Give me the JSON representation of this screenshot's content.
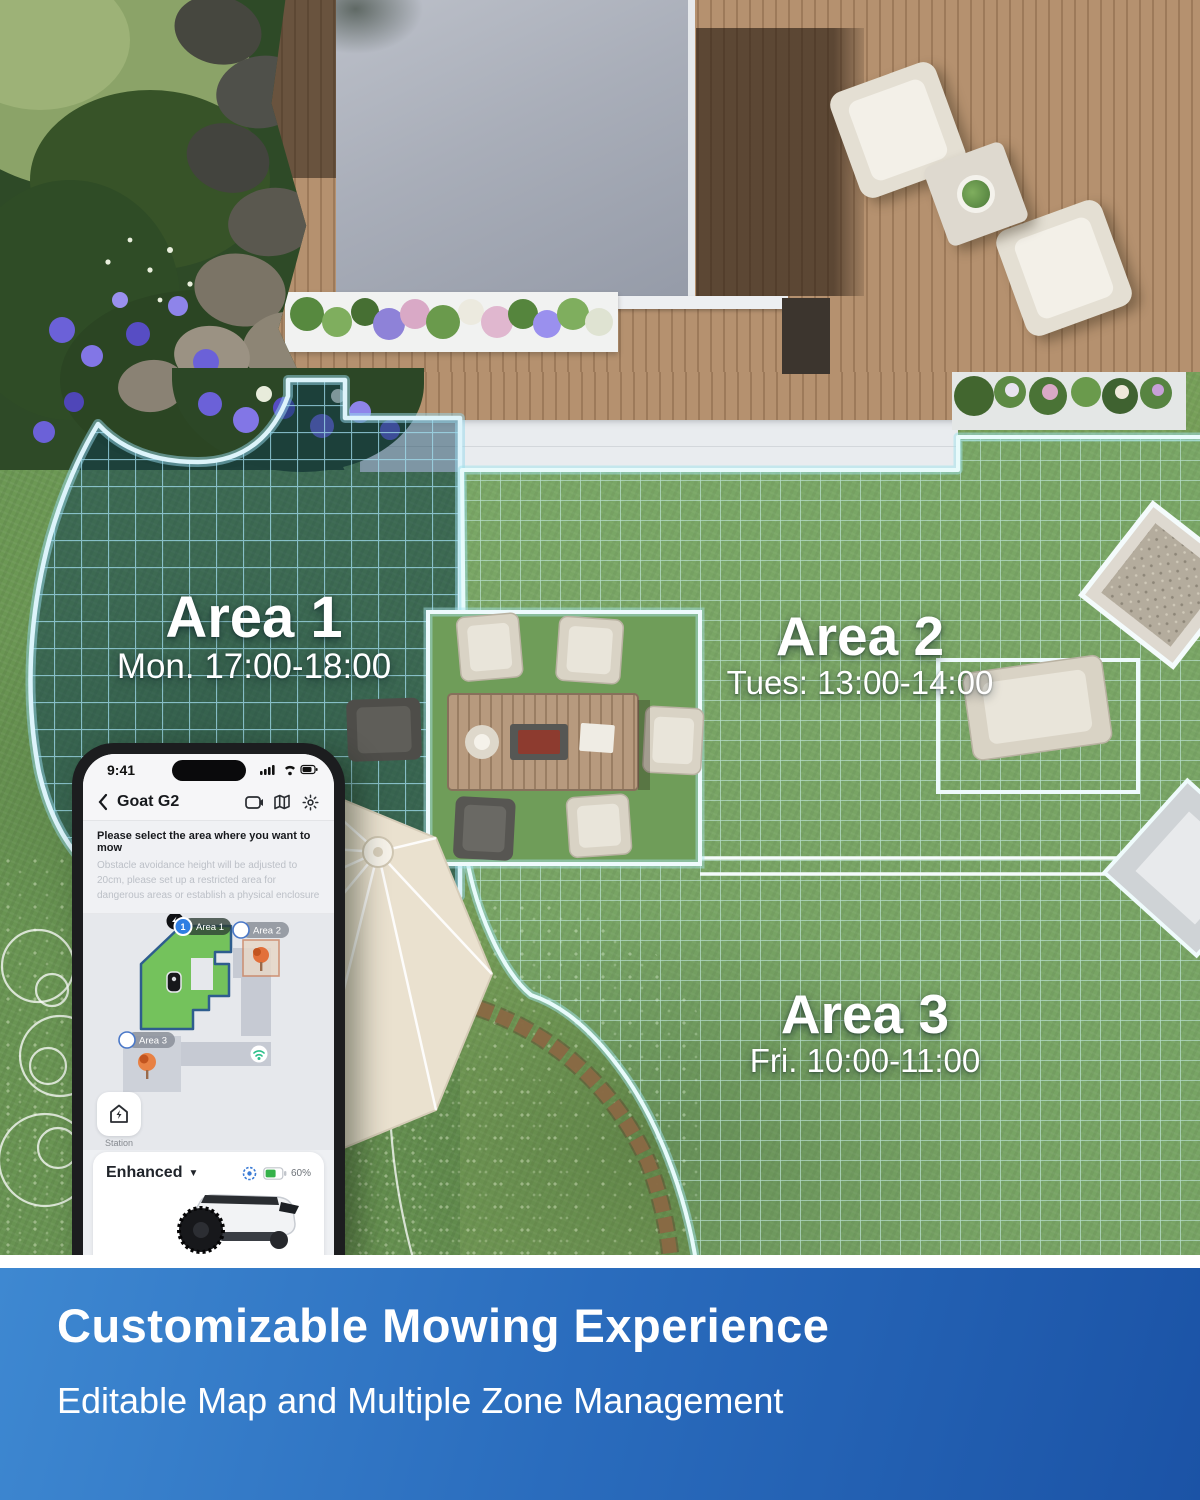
{
  "yard": {
    "zones": [
      {
        "label": "Area 1",
        "schedule": "Mon. 17:00-18:00"
      },
      {
        "label": "Area 2",
        "schedule": "Tues: 13:00-14:00"
      },
      {
        "label": "Area 3",
        "schedule": "Fri. 10:00-11:00"
      }
    ]
  },
  "phone": {
    "status_time": "9:41",
    "nav_title": "Goat G2",
    "instruction_title": "Please select the area where you want to mow",
    "instruction_body": "Obstacle avoidance height will be adjusted to 20cm, please set up a restricted area for dangerous areas or establish a physical enclosure",
    "map": {
      "area1": "Area 1",
      "area1_num": "1",
      "area2": "Area 2",
      "area3": "Area 3"
    },
    "station_label": "Station",
    "mode_label": "Enhanced",
    "battery_pct": "60%",
    "start_label": "Start"
  },
  "banner": {
    "title": "Customizable Mowing Experience",
    "subtitle": "Editable Map and Multiple Zone Management"
  },
  "colors": {
    "accent_blue": "#2f7ee2",
    "grid_line_area1": "rgba(160,220,238,0.75)",
    "grid_line_area23": "rgba(205,242,238,0.7)",
    "zone_border": "#ddf4fb",
    "start_button": "#22374d",
    "banner_start": "#3e88d1",
    "banner_end": "#1b53a6",
    "map_zone_green": "#74c25c",
    "battery_green": "#35b24a"
  }
}
